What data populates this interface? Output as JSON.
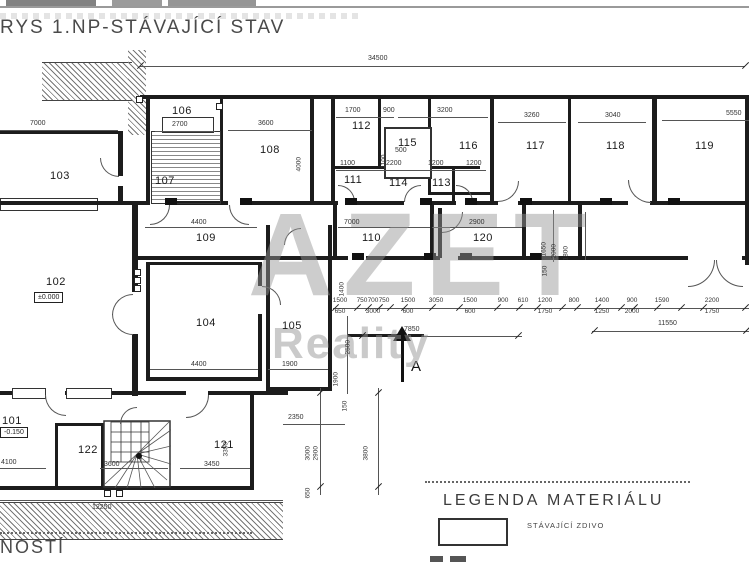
{
  "title": "RYS 1.NP-STÁVAJÍCÍ STAV",
  "watermark": {
    "line1": "AZET",
    "line2": "Reality"
  },
  "legend": {
    "title": "LEGENDA MATERIÁLU",
    "items": [
      {
        "label": "STÁVAJÍCÍ ZDIVO"
      }
    ]
  },
  "bottom_left_text": "NOSTÍ",
  "section_marker": {
    "label": "A"
  },
  "top_dimension": "34500",
  "rooms": [
    {
      "t": "101",
      "x": 2,
      "y": 415
    },
    {
      "t": "102",
      "x": 46,
      "y": 276
    },
    {
      "t": "103",
      "x": 50,
      "y": 170
    },
    {
      "t": "104",
      "x": 196,
      "y": 317
    },
    {
      "t": "105",
      "x": 282,
      "y": 320
    },
    {
      "t": "106",
      "x": 172,
      "y": 105
    },
    {
      "t": "107",
      "x": 155,
      "y": 175
    },
    {
      "t": "108",
      "x": 260,
      "y": 144
    },
    {
      "t": "109",
      "x": 196,
      "y": 232
    },
    {
      "t": "110",
      "x": 362,
      "y": 232
    },
    {
      "t": "111",
      "x": 344,
      "y": 174
    },
    {
      "t": "112",
      "x": 352,
      "y": 120
    },
    {
      "t": "113",
      "x": 432,
      "y": 177
    },
    {
      "t": "114",
      "x": 389,
      "y": 177
    },
    {
      "t": "115",
      "x": 398,
      "y": 137
    },
    {
      "t": "116",
      "x": 459,
      "y": 140
    },
    {
      "t": "117",
      "x": 526,
      "y": 140
    },
    {
      "t": "118",
      "x": 606,
      "y": 140
    },
    {
      "t": "119",
      "x": 695,
      "y": 140
    },
    {
      "t": "120",
      "x": 473,
      "y": 232
    },
    {
      "t": "121",
      "x": 214,
      "y": 439
    },
    {
      "t": "122",
      "x": 78,
      "y": 444
    }
  ],
  "elevations": [
    {
      "t": "±0.000",
      "x": 34,
      "y": 292
    },
    {
      "t": "-0.150",
      "x": 0,
      "y": 427
    }
  ],
  "dims_h": [
    {
      "t": "34500",
      "x": 368,
      "y": 55
    },
    {
      "t": "7000",
      "x": 30,
      "y": 120
    },
    {
      "t": "2700",
      "x": 172,
      "y": 121
    },
    {
      "t": "3600",
      "x": 258,
      "y": 120
    },
    {
      "t": "1700",
      "x": 345,
      "y": 107
    },
    {
      "t": "900",
      "x": 383,
      "y": 107
    },
    {
      "t": "3200",
      "x": 437,
      "y": 107
    },
    {
      "t": "3260",
      "x": 524,
      "y": 112
    },
    {
      "t": "3040",
      "x": 605,
      "y": 112
    },
    {
      "t": "5550",
      "x": 726,
      "y": 110
    },
    {
      "t": "500",
      "x": 395,
      "y": 147
    },
    {
      "t": "1100",
      "x": 340,
      "y": 160
    },
    {
      "t": "2200",
      "x": 386,
      "y": 160
    },
    {
      "t": "1200",
      "x": 428,
      "y": 160
    },
    {
      "t": "1200",
      "x": 466,
      "y": 160
    },
    {
      "t": "4400",
      "x": 191,
      "y": 219
    },
    {
      "t": "7000",
      "x": 344,
      "y": 219
    },
    {
      "t": "2900",
      "x": 469,
      "y": 219
    },
    {
      "t": "4400",
      "x": 191,
      "y": 361
    },
    {
      "t": "1900",
      "x": 282,
      "y": 361
    },
    {
      "t": "2350",
      "x": 288,
      "y": 414
    },
    {
      "t": "4100",
      "x": 1,
      "y": 459
    },
    {
      "t": "3600",
      "x": 104,
      "y": 461
    },
    {
      "t": "3450",
      "x": 204,
      "y": 461
    },
    {
      "t": "12250",
      "x": 92,
      "y": 504
    },
    {
      "t": "7850",
      "x": 404,
      "y": 326
    },
    {
      "t": "11550",
      "x": 658,
      "y": 320
    }
  ],
  "dims_v": [
    {
      "t": "4000",
      "x": 303,
      "y": 165
    },
    {
      "t": "1100",
      "x": 388,
      "y": 162
    },
    {
      "t": "1400",
      "x": 346,
      "y": 290
    },
    {
      "t": "1650",
      "x": 548,
      "y": 250
    },
    {
      "t": "2000",
      "x": 558,
      "y": 252
    },
    {
      "t": "1800",
      "x": 570,
      "y": 254
    },
    {
      "t": "150",
      "x": 549,
      "y": 270
    },
    {
      "t": "1900",
      "x": 340,
      "y": 380
    },
    {
      "t": "150",
      "x": 349,
      "y": 405
    },
    {
      "t": "2500",
      "x": 352,
      "y": 348
    },
    {
      "t": "3000",
      "x": 312,
      "y": 454
    },
    {
      "t": "2900",
      "x": 320,
      "y": 454
    },
    {
      "t": "3800",
      "x": 370,
      "y": 454
    },
    {
      "t": "650",
      "x": 312,
      "y": 492
    },
    {
      "t": "3350",
      "x": 230,
      "y": 450
    }
  ],
  "chain": [
    {
      "a": "1500",
      "b": "650",
      "x": 340
    },
    {
      "a": "750",
      "b": "",
      "x": 362
    },
    {
      "a": "700",
      "b": "3000",
      "x": 373
    },
    {
      "a": "750",
      "b": "",
      "x": 384
    },
    {
      "a": "1500",
      "b": "600",
      "x": 408
    },
    {
      "a": "3050",
      "b": "",
      "x": 436
    },
    {
      "a": "1500",
      "b": "600",
      "x": 470
    },
    {
      "a": "900",
      "b": "",
      "x": 503
    },
    {
      "a": "610",
      "b": "",
      "x": 523
    },
    {
      "a": "1200",
      "b": "1750",
      "x": 545
    },
    {
      "a": "800",
      "b": "",
      "x": 574
    },
    {
      "a": "1400",
      "b": "1250",
      "x": 602
    },
    {
      "a": "900",
      "b": "2000",
      "x": 632
    },
    {
      "a": "1590",
      "b": "",
      "x": 662
    },
    {
      "a": "2200",
      "b": "1750",
      "x": 712
    }
  ]
}
